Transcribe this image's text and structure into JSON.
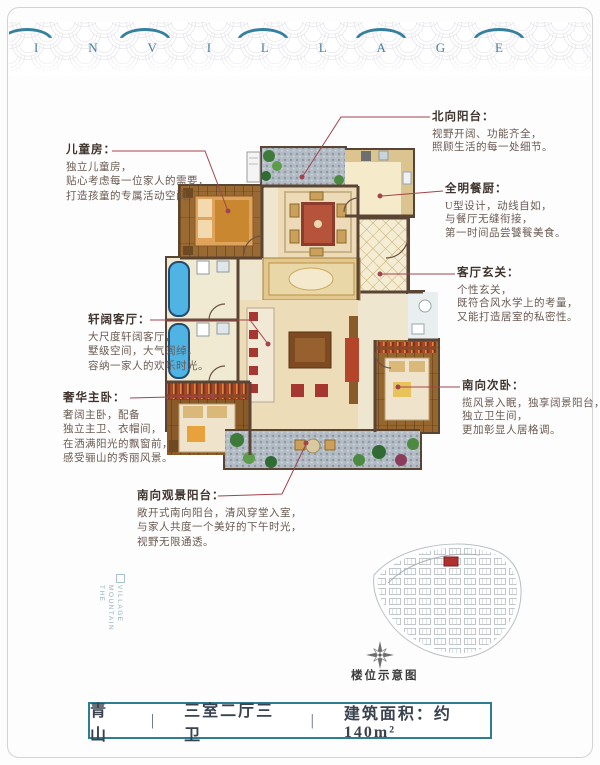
{
  "header": {
    "brand_letters": [
      "I",
      "N",
      "V",
      "I",
      "L",
      "L",
      "A",
      "G",
      "E"
    ]
  },
  "annotations": {
    "children_room": {
      "title": "儿童房：",
      "lines": [
        "独立儿童房，",
        "贴心考虑每一位家人的需要，",
        "打造孩童的专属活动空间。"
      ]
    },
    "grand_living": {
      "title": "轩阔客厅：",
      "lines": [
        "大尺度轩阔客厅，",
        "墅级空间，大气阔绰，",
        "容纳一家人的欢乐时光。"
      ]
    },
    "master_bedroom": {
      "title": "奢华主卧：",
      "lines": [
        "奢阔主卧，配备",
        "独立主卫、衣帽间，",
        "在洒满阳光的飘窗前，",
        "感受骊山的秀丽风景。"
      ]
    },
    "south_balcony": {
      "title": "南向观景阳台：",
      "lines": [
        "敞开式南向阳台，清风穿堂入室，",
        "与家人共度一个美好的下午时光，",
        "视野无限通透。"
      ]
    },
    "north_balcony": {
      "title": "北向阳台：",
      "lines": [
        "视野开阔、功能齐全，",
        "照顾生活的每一处细节。"
      ]
    },
    "kitchen": {
      "title": "全明餐厨：",
      "lines": [
        "U型设计，动线自如，",
        "与餐厅无缝衔接，",
        "第一时间品尝饕餮美食。"
      ]
    },
    "foyer": {
      "title": "客厅玄关：",
      "lines": [
        "个性玄关，",
        "既符合风水学上的考量，",
        "又能打造居室的私密性。"
      ]
    },
    "second_bedroom": {
      "title": "南向次卧：",
      "lines": [
        "揽风景入眠，独享阔景阳台，",
        "独立卫生间，",
        "更加彰显人居格调。"
      ]
    }
  },
  "site_map": {
    "caption": "楼位示意图"
  },
  "side_text": {
    "line1": "VILLAGE MOUNTAIN",
    "line2": "THE"
  },
  "footer": {
    "name": "青山",
    "separator": "|",
    "layout": "三室二厅三卫",
    "area_label": "建筑面积：约140m²"
  },
  "colors": {
    "annotation_red": "#a2444c",
    "wall_brown": "#5a4434",
    "tub_blue": "#4fb3e3",
    "footer_teal": "#2e7e93",
    "brand_blue": "#4b7d9a"
  }
}
